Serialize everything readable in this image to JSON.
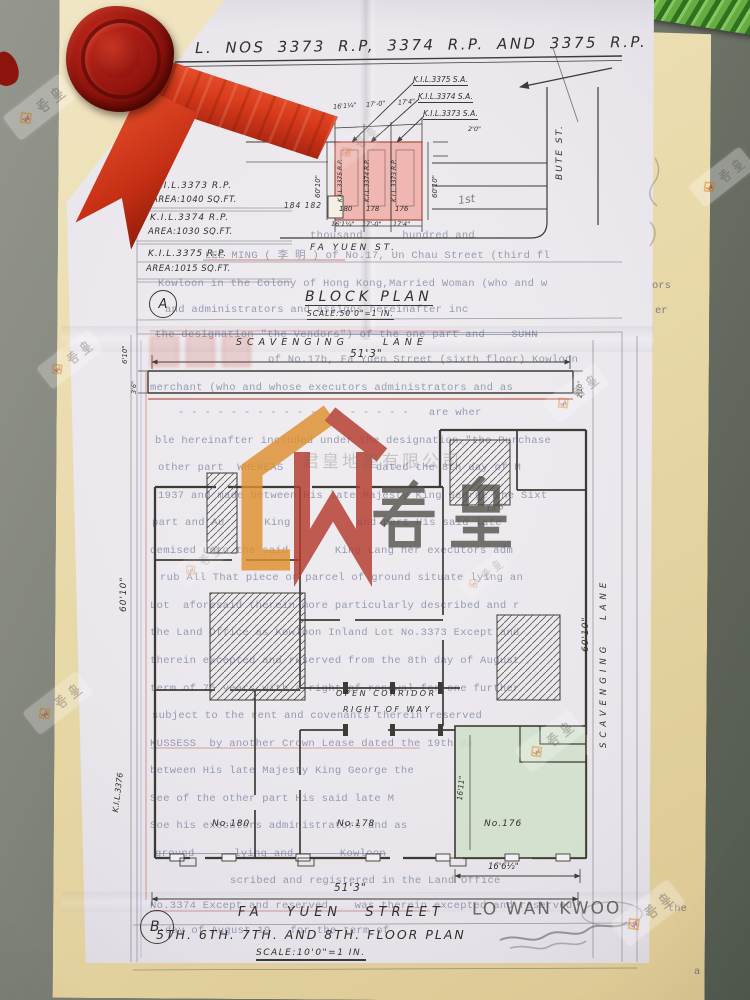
{
  "doc": {
    "title": "L. NOS 3373 R.P, 3374 R.P. AND 3375 R.P.",
    "block": {
      "section": "A",
      "title": "BLOCK PLAN",
      "scale": "SCALE:50'0\"=1 IN.",
      "lots": [
        {
          "lot": "K.I.L.3373 R.P.",
          "area": "AREA:1040 SQ.FT."
        },
        {
          "lot": "K.I.L.3374 R.P.",
          "area": "AREA:1030 SQ.FT."
        },
        {
          "lot": "K.I.L.3375 R.P.",
          "area": "AREA:1015 SQ.FT."
        }
      ],
      "leaders": [
        "K.I.L.3375 S.A.",
        "K.I.L.3374 S.A.",
        "K.I.L.3373 S.A."
      ],
      "top_dims": [
        "16'1¼\"",
        "17'-0\"",
        "17'4\""
      ],
      "bottom_dims": [
        "16'1¼\"",
        "17'-0\"",
        "17'4\""
      ],
      "strip_lots": [
        "K.I.L.3375 R.P.",
        "K.I.L.3374 R.P.",
        "K.I.L.3373 R.P."
      ],
      "house_nos": [
        "180",
        "178",
        "176"
      ],
      "dim_left": "60'10\"",
      "dim_right": "60'10\"",
      "dim_offset": "2'0\"",
      "neighbors": "184 182",
      "scav_lane": "SCAV. LANE.",
      "bute_st": "BUTE ST.",
      "fa_yuen": "FA YUEN ST."
    },
    "floor": {
      "section": "B.",
      "lane_top": "SCAVENGING LANE",
      "dim_top": "51'3\"",
      "dim_left_small": "3'6\"",
      "dim_left_top": "6'10\"",
      "dim_right_small": "2'10\"",
      "dim_left": "60'10\"",
      "dim_right": "60'10\"",
      "lane_right": "SCAVENGING LANE",
      "lot_left": "K.I.L.3376",
      "corridor1": "OPEN CORRIDOR",
      "corridor2": "RIGHT OF WAY",
      "rooms": [
        "No.180",
        "No.178",
        "No.176"
      ],
      "dim_green": "16'11\"",
      "dim_pencil": "13'6\"",
      "dim_bottom_right": "16'6½\"",
      "dim_bottom": "51'3\"",
      "street": "FA YUEN STREET",
      "pencil_name": "LO WAN KWOO",
      "floors": "5TH. 6TH. 7TH. AND 8TH. FLOOR PLAN",
      "scale": "SCALE:10'0\"=1 IN."
    },
    "typed_lines": [
      {
        "x": 310,
        "y": 231,
        "t": "thousand      hundred and",
        "cls": ""
      },
      {
        "x": 205,
        "y": 251,
        "t": "LEE MING ( 李 明 ) of No.17, Un Chau Street (third fl",
        "cls": ""
      },
      {
        "x": 158,
        "y": 279,
        "t": "Kowloon in the Colony of Hong Kong,Married Woman (who and w",
        "cls": ""
      },
      {
        "x": 165,
        "y": 305,
        "t": "and administrators and assigns hereinafter inc",
        "cls": ""
      },
      {
        "x": 155,
        "y": 330,
        "t": "the designation \"the Vendors\") of the one part and    SUHN",
        "cls": "strike"
      },
      {
        "x": 268,
        "y": 355,
        "t": "of No.17b, Fa Yuen Street (sixth floor) Kowloon",
        "cls": ""
      },
      {
        "x": 150,
        "y": 383,
        "t": "merchant (who and whose executors administrators and as",
        "cls": ""
      },
      {
        "x": 178,
        "y": 408,
        "t": "- - - - - - - - - - - - - - - - - -   are wher",
        "cls": ""
      },
      {
        "x": 155,
        "y": 436,
        "t": "ble hereinafter included under the designation \"the Purchase",
        "cls": ""
      },
      {
        "x": 158,
        "y": 463,
        "t": "other part  WHEREAS              dated the 8th day of M",
        "cls": ""
      },
      {
        "x": 158,
        "y": 491,
        "t": "1937 and made between His late Majesty King George the Sixt",
        "cls": ""
      },
      {
        "x": 152,
        "y": 518,
        "t": "part and Au      King          and part His said late",
        "cls": ""
      },
      {
        "x": 150,
        "y": 546,
        "t": "demised unto the said       King Lang her executors adm",
        "cls": ""
      },
      {
        "x": 160,
        "y": 573,
        "t": "rub All That piece or parcel of ground situate lying an",
        "cls": ""
      },
      {
        "x": 150,
        "y": 601,
        "t": "Lot  aforesaid therein more particularly described and r",
        "cls": ""
      },
      {
        "x": 150,
        "y": 628,
        "t": "the Land Office as Kowloon Inland Lot No.3373 Except and",
        "cls": ""
      },
      {
        "x": 150,
        "y": 656,
        "t": "therein excepted and reserved from the 8th day of August",
        "cls": ""
      },
      {
        "x": 150,
        "y": 684,
        "t": "term of 75 years with a right of renewal for one further",
        "cls": ""
      },
      {
        "x": 152,
        "y": 711,
        "t": "subject to the rent and covenants therein reserved",
        "cls": ""
      },
      {
        "x": 150,
        "y": 739,
        "t": "KUSSESS  by another Crown Lease dated the 19th da",
        "cls": ""
      },
      {
        "x": 150,
        "y": 766,
        "t": "between His late Majesty King George the",
        "cls": ""
      },
      {
        "x": 150,
        "y": 794,
        "t": "See of the other part His said late M",
        "cls": ""
      },
      {
        "x": 150,
        "y": 821,
        "t": "Soe his executors administrators and as",
        "cls": ""
      },
      {
        "x": 155,
        "y": 849,
        "t": "ground      lying and       Kowloon",
        "cls": "strike"
      },
      {
        "x": 230,
        "y": 876,
        "t": "scribed and registered in the Land Office",
        "cls": ""
      },
      {
        "x": 150,
        "y": 901,
        "t": "No.3374 Except and reserved    was therein excepted and reserved",
        "cls": ""
      },
      {
        "x": 165,
        "y": 926,
        "t": "day of August 19   for the term of",
        "cls": ""
      }
    ],
    "edge_fragments": [
      {
        "x": 652,
        "y": 280,
        "t": "ors"
      },
      {
        "x": 655,
        "y": 305,
        "t": "er"
      },
      {
        "x": 668,
        "y": 903,
        "t": "the"
      },
      {
        "x": 694,
        "y": 966,
        "t": "a"
      }
    ],
    "pencil_notes": [
      {
        "x": 458,
        "y": 193,
        "t": "1st"
      }
    ]
  },
  "watermark": {
    "chars": "君皇",
    "company": "君皇地產有限公司"
  },
  "colors": {
    "ink": "#3e3a35",
    "red_line": "#b9584c",
    "pink_fill": "#efb0ab",
    "green_fill": "#cfe0c9",
    "wax": "#8f140f",
    "ribbon": "#d63d22",
    "tan": "#e7d8a8",
    "table": "#6e736a",
    "typed": "#8a93ab"
  }
}
